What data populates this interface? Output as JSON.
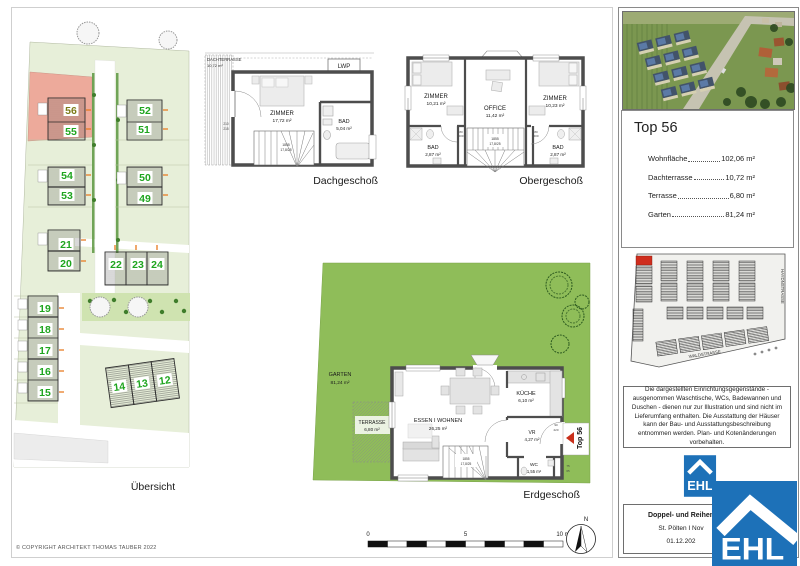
{
  "sheet": {
    "copyright": "© COPYRIGHT ARCHITEKT THOMAS TAUBER 2022",
    "scale": {
      "zero": "0",
      "five": "5",
      "ten": "10 m",
      "north": "N"
    }
  },
  "site_plan": {
    "caption": "Übersicht",
    "units": [
      "56",
      "55",
      "52",
      "51",
      "54",
      "53",
      "50",
      "49",
      "21",
      "20",
      "22",
      "23",
      "24",
      "19",
      "18",
      "17",
      "16",
      "15",
      "14",
      "13",
      "12"
    ]
  },
  "dach": {
    "caption": "Dachgeschoß",
    "terrace": "DACHTERRASSE",
    "terrace_area": "10,72 m²",
    "lwp": "LWP",
    "zimmer": "ZIMMER",
    "zimmer_area": "17,72 m²",
    "bad": "BAD",
    "bad_area": "5,04 m²",
    "stairs1": "1855",
    "stairs2": "17,8/25",
    "dim1": "210",
    "dim2": "215"
  },
  "ober": {
    "caption": "Obergeschoß",
    "zimmer_l": "ZIMMER",
    "zimmer_l_area": "10,21 m²",
    "office": "OFFICE",
    "office_area": "11,42 m²",
    "zimmer_r": "ZIMMER",
    "zimmer_r_area": "10,23 m²",
    "bad_l": "BAD",
    "bad_l_area": "2,87 m²",
    "bad_r": "BAD",
    "bad_r_area": "2,87 m²",
    "stairs1": "1855",
    "stairs2": "17,8/25",
    "dim_w": "80",
    "dim_h": "200"
  },
  "erd": {
    "caption": "Erdgeschoß",
    "garten": "GARTEN",
    "garten_area": "81,24 m²",
    "terrasse": "TERRASSE",
    "terrasse_area": "6,80 m²",
    "wohnen": "ESSEN I WOHNEN",
    "wohnen_area": "26,25 m²",
    "kueche": "KÜCHE",
    "kueche_area": "6,10 m²",
    "vr": "VR",
    "vr_area": "4,27 m²",
    "wc": "WC",
    "wc_area": "1,55 m²",
    "top_label": "Top 56",
    "stairs1": "1855",
    "stairs2": "17,8/25",
    "dim_door_w": "90",
    "dim_door_h": "220",
    "dim_win_w": "75",
    "dim_win_h": "65"
  },
  "panel": {
    "info": {
      "title": "Top 56",
      "rows": [
        {
          "label": "Wohnfläche",
          "value": "102,06 m²"
        },
        {
          "label": "Dachterrasse",
          "value": "10,72 m²"
        },
        {
          "label": "Terrasse",
          "value": "6,80 m²"
        },
        {
          "label": "Garten",
          "value": "81,24 m²"
        }
      ]
    },
    "map": {
      "street_right": "HAYDNSTRASSE",
      "street_bottom": "WALDSTRASSE"
    },
    "disclaimer": "Die dargestellten Einrichtungsgegenstände - ausgenommen Waschtische, WCs, Badewannen und Duschen - dienen nur zur Illustration und sind nicht im Lieferumfang enthalten. Die Ausstattung der Häuser kann der Bau- und Ausstattungsbeschreibung entnommen werden. Plan- und Kotenänderungen vorbehalten.",
    "logo_text": "EHL",
    "footer": {
      "line1": "Doppel- und Reihen",
      "line2": "St. Pölten I Nov",
      "line3": "01.12.202"
    }
  },
  "colors": {
    "accent_red": "#c92f1b",
    "unit_green": "#1fa51f",
    "ehl_blue": "#1d71b8",
    "garden_green": "#8fbd59"
  }
}
